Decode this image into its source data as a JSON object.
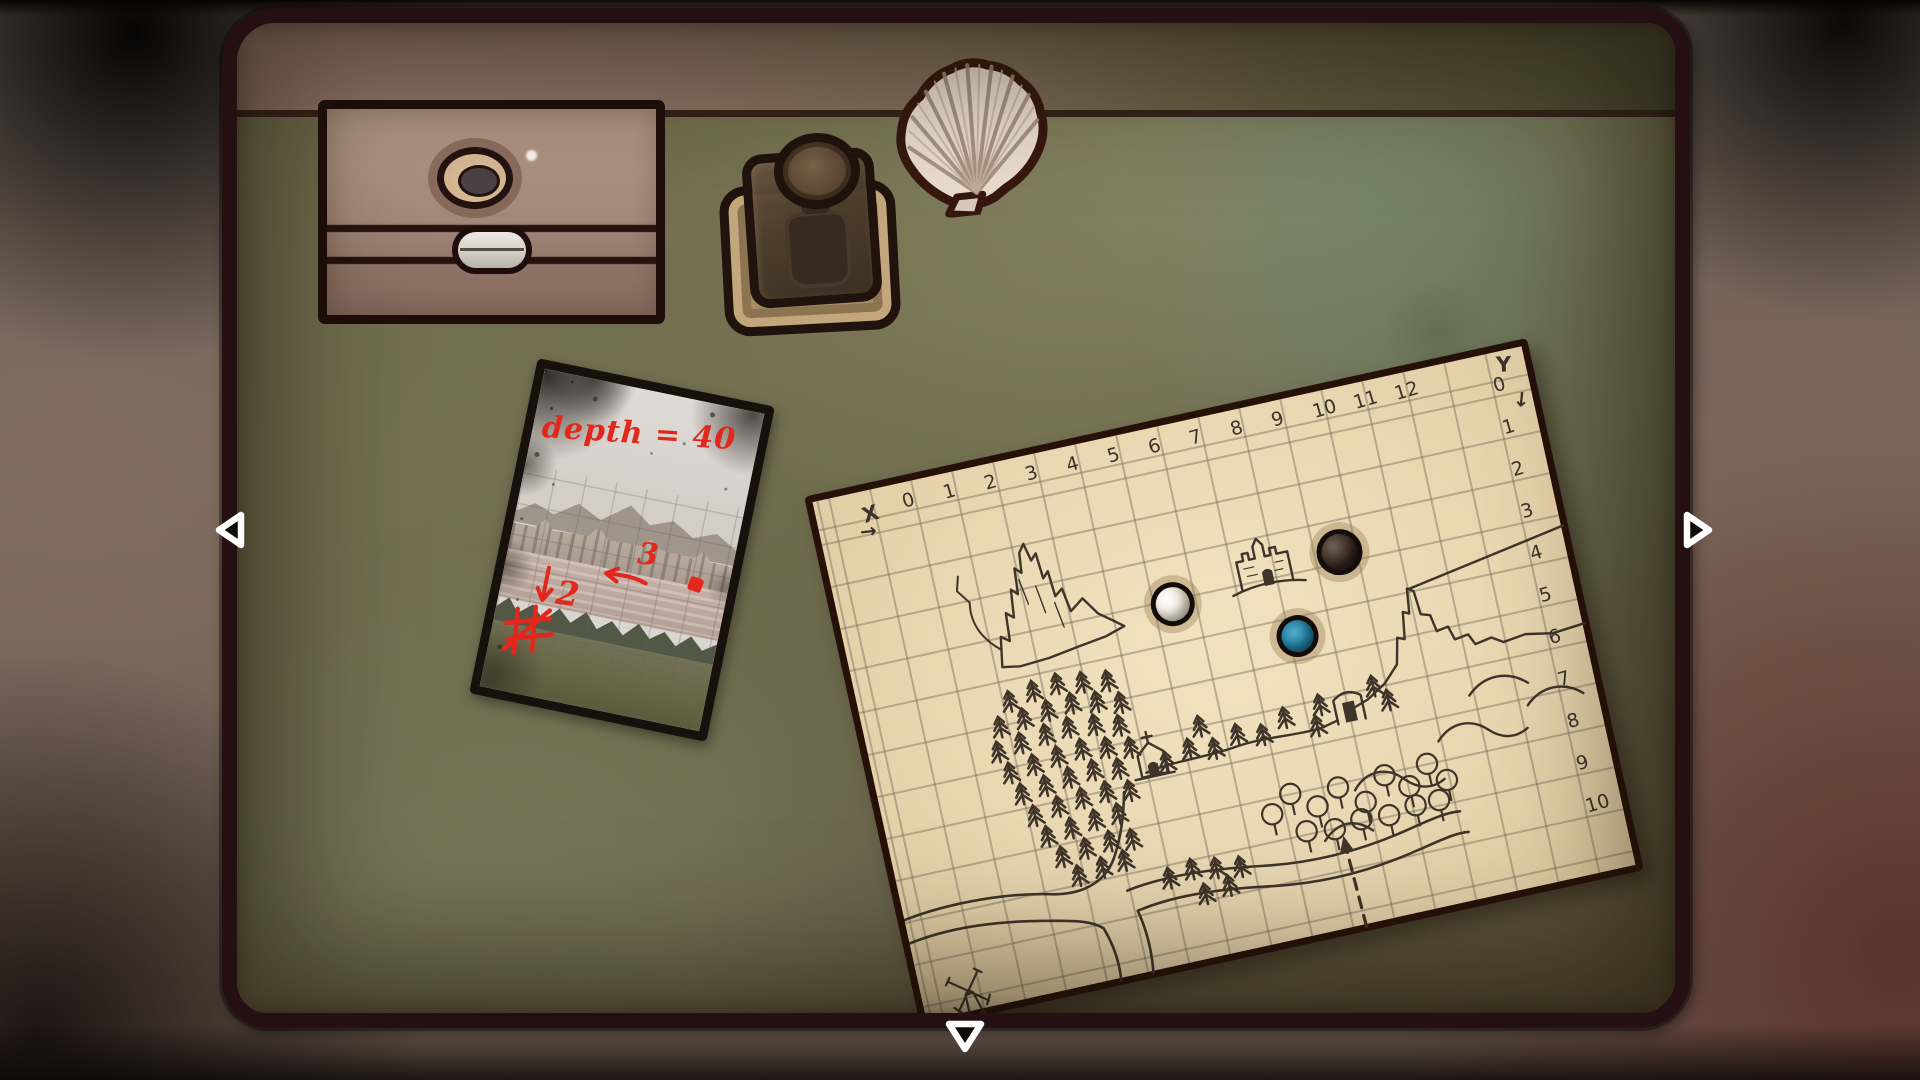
{
  "nav": {
    "left": {
      "icon": "triangle-left-icon"
    },
    "right": {
      "icon": "triangle-right-icon"
    },
    "down": {
      "icon": "triangle-down-icon"
    },
    "fill": "#0d0a08",
    "outline": "#ffffff"
  },
  "objects": {
    "box": {
      "label": "wooden box with keyhole and clasp",
      "lid_color": "#ab9082",
      "body_color": "#8f7366",
      "clasp_color": "#d8d4cd"
    },
    "jar": {
      "label": "glass jar on stand",
      "glass_color": "#4a3a2a",
      "base_color": "#a78d66"
    },
    "shell": {
      "label": "scallop shell",
      "color": "#e9dccd"
    },
    "postcard": {
      "label": "annotated photo card",
      "depth_note": "depth = 40",
      "note_3": "3",
      "note_2": "2",
      "arrow_left": "arrow-left-icon",
      "arrow_down": "arrow-down-icon",
      "crossed_grid": "crossed-grid-icon",
      "ink_color": "#e2271c"
    },
    "map": {
      "label": "hand-drawn grid map",
      "paper_color": "#e9d7b2",
      "x_axis": {
        "label": "X",
        "arrow": "→",
        "values": [
          "0",
          "1",
          "2",
          "3",
          "4",
          "5",
          "6",
          "7",
          "8",
          "9",
          "10",
          "11",
          "12"
        ]
      },
      "y_axis": {
        "label": "Y",
        "arrow": "↓",
        "values": [
          "0",
          "1",
          "2",
          "3",
          "4",
          "5",
          "6",
          "7",
          "8",
          "9",
          "10"
        ]
      },
      "marbles": [
        {
          "name": "white-marble",
          "color": "#efe9dd"
        },
        {
          "name": "black-marble",
          "color": "#2c1f19"
        },
        {
          "name": "blue-marble",
          "color": "#1f7195"
        }
      ]
    }
  }
}
